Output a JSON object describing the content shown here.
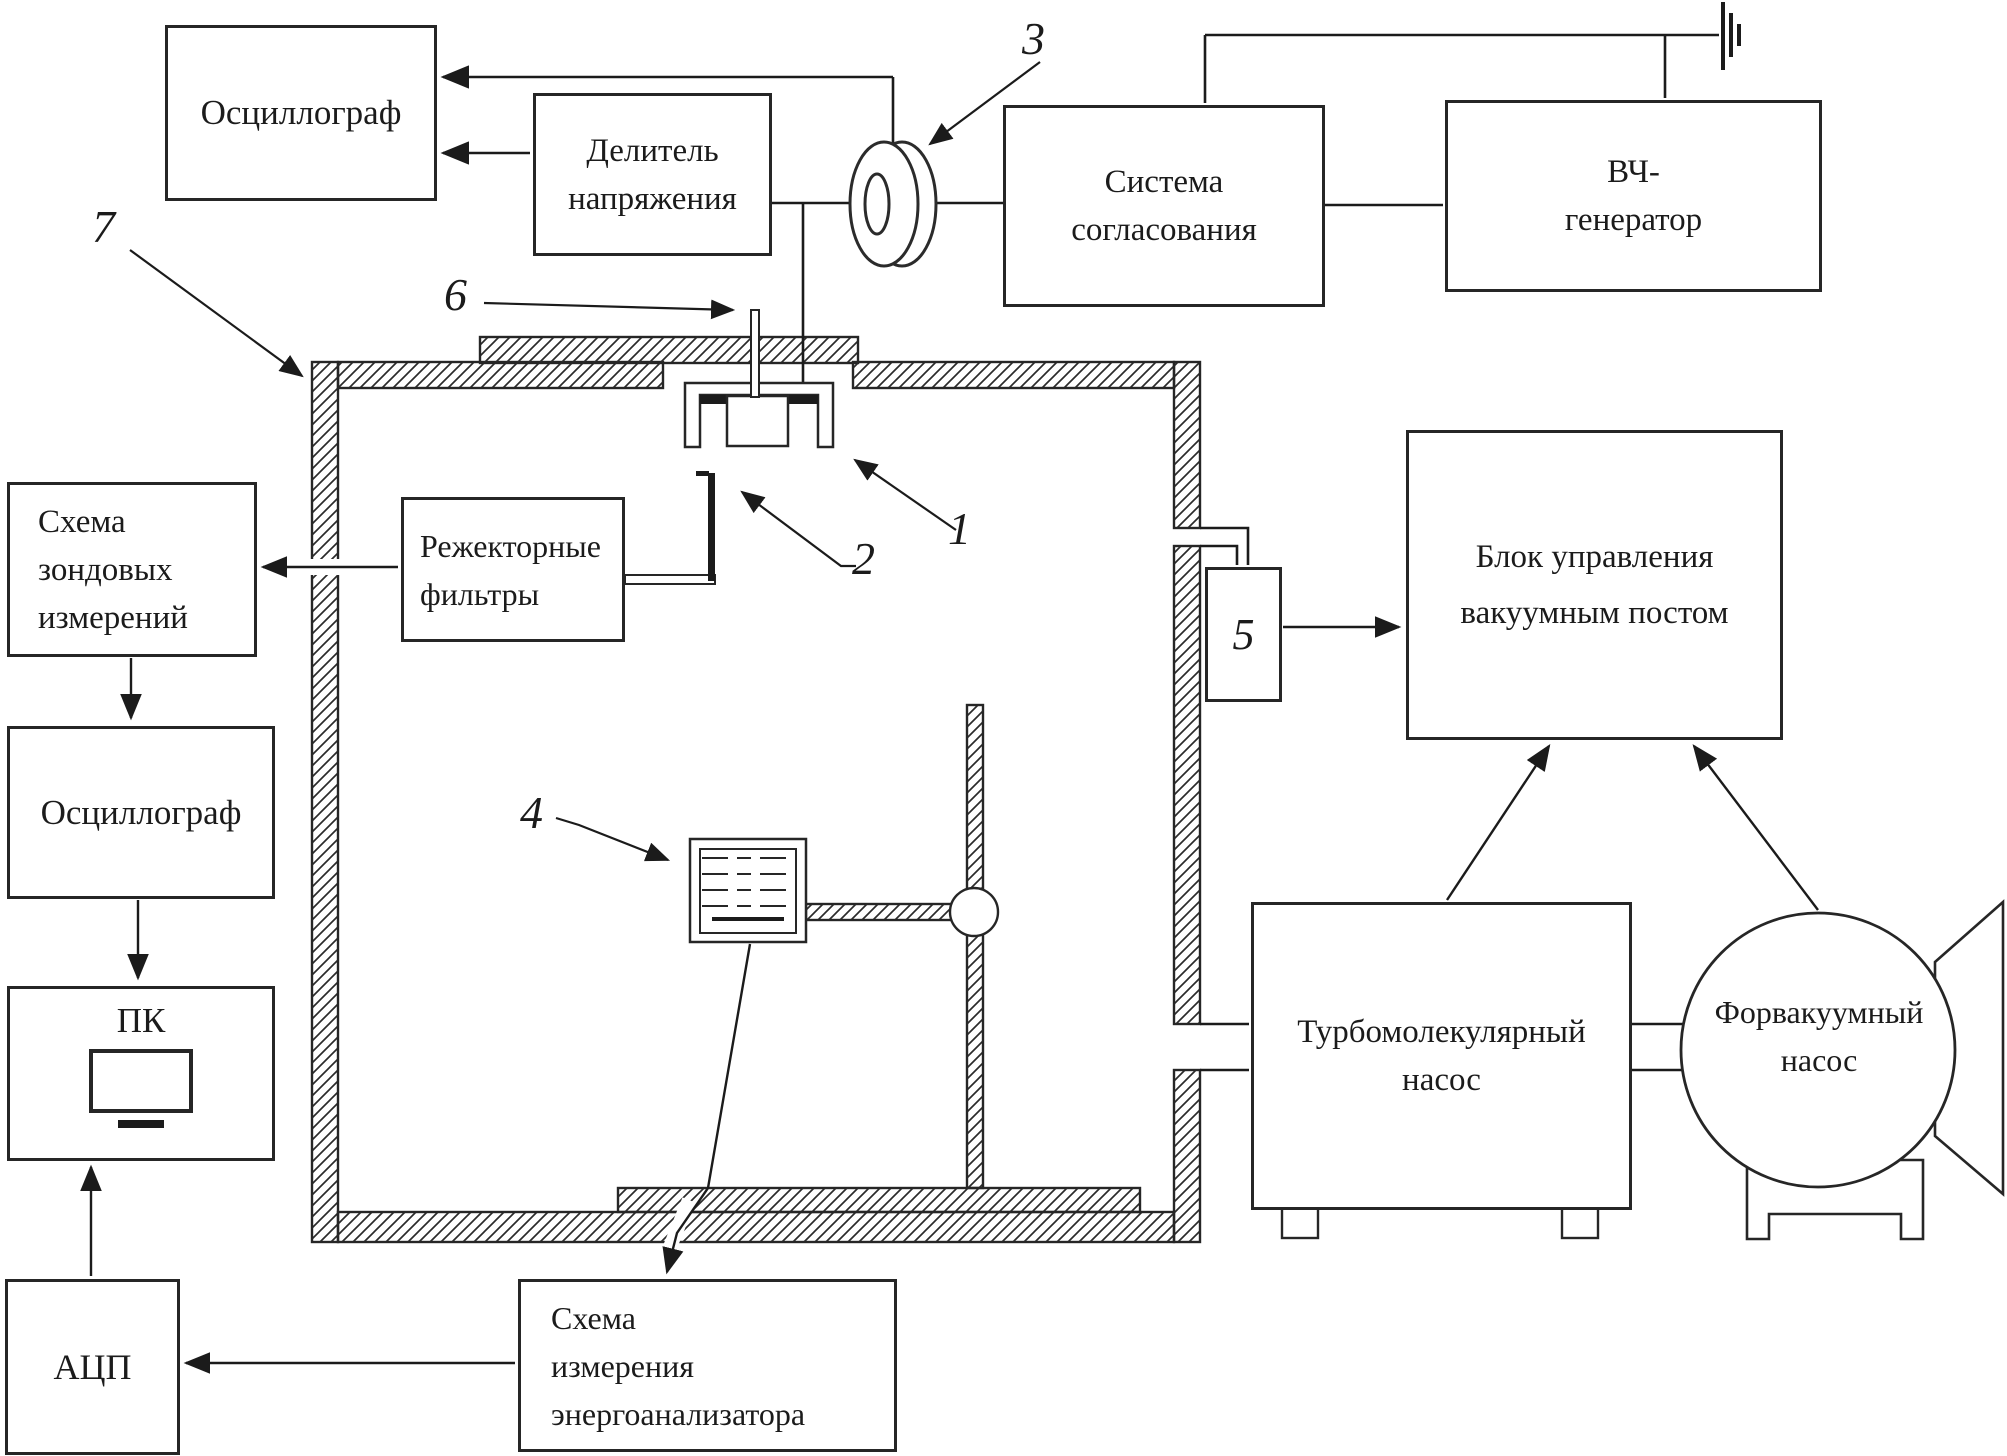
{
  "colors": {
    "line": "#1b1b1b",
    "background": "#ffffff"
  },
  "boxes": {
    "osc_top": {
      "lines": [
        "Осциллограф"
      ]
    },
    "divider": {
      "lines": [
        "Делитель",
        "напряжения"
      ]
    },
    "matching": {
      "lines": [
        "Система",
        "согласования"
      ]
    },
    "rf_gen": {
      "lines": [
        "ВЧ-",
        "генератор"
      ]
    },
    "control": {
      "lines": [
        "Блок управления",
        "вакуумным постом"
      ]
    },
    "probe_circuit": {
      "lines": [
        "Схема",
        "зондовых",
        "измерений"
      ]
    },
    "notch": {
      "lines": [
        "Режекторные",
        "фильтры"
      ]
    },
    "osc_left": {
      "lines": [
        "Осциллограф"
      ]
    },
    "pc": {
      "label": "ПК"
    },
    "adc": {
      "label": "АЦП"
    },
    "analyzer_circuit": {
      "lines": [
        "Схема",
        "измерения",
        "энергоанализатора"
      ]
    },
    "turbo": {
      "lines": [
        "Турбомолекулярный",
        "насос"
      ]
    },
    "forepump": {
      "lines": [
        "Форвакуумный",
        "насос"
      ]
    },
    "valve5": {
      "label": "5"
    }
  },
  "callouts": {
    "n1": "1",
    "n2": "2",
    "n3": "3",
    "n4": "4",
    "n6": "6",
    "n7": "7"
  }
}
